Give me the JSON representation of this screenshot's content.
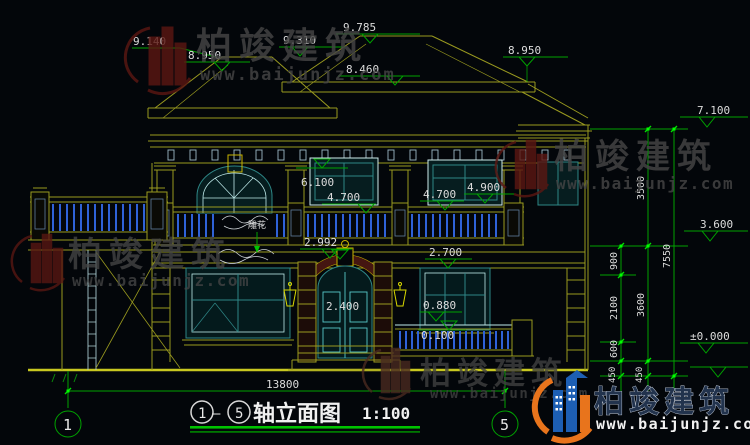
{
  "drawing": {
    "title": {
      "axis_from": "1",
      "separator": "—",
      "axis_to": "5",
      "name": "轴立面图",
      "scale": "1:100"
    },
    "axis_markers": {
      "left": "1",
      "right": "5"
    },
    "elevation_labels": {
      "roof_left_outer": "9.140",
      "roof_left_eave": "8.950",
      "roof_left_ridge": "9.310",
      "roof_main_ridge": "9.785",
      "roof_main_eave": "8.460",
      "roof_right_eave": "8.950",
      "right_wing_eave": "7.100",
      "second_floor": "3.600",
      "ground_level": "±0.000",
      "window2f_top": "6.100",
      "balcony_left": "4.700",
      "balcony_right": "4.700",
      "parapet_right": "4.900",
      "slab_level": "2.992",
      "window1f_top": "2.700",
      "door_height": "2.400",
      "window_sill": "0.880",
      "porch_level": "0.100"
    },
    "dimension_labels": {
      "bottom_total": "13800",
      "right_total": "7550",
      "upper_storey": "3500",
      "lower_storey": "3600",
      "seg_900": "900",
      "seg_2100": "2100",
      "seg_600": "600",
      "seg_450_a": "450",
      "seg_450_b": "450"
    },
    "annotations": {
      "carving": "雕花"
    }
  },
  "watermark": {
    "brand": "柏竣建筑",
    "url": "www.baijunjz.com"
  },
  "colors": {
    "line_yellow": "#9a9a1f",
    "bright_yellow": "#d8d800",
    "dim_green": "#00a300",
    "tick_green": "#00e000",
    "dim_text": "#dcdcdc",
    "window_teal": "#2e8686",
    "baluster_blue": "#2f62d8",
    "arch_maroon": "#451611",
    "logo_blue": "#1d5fb4",
    "logo_orange": "#e8741c"
  }
}
